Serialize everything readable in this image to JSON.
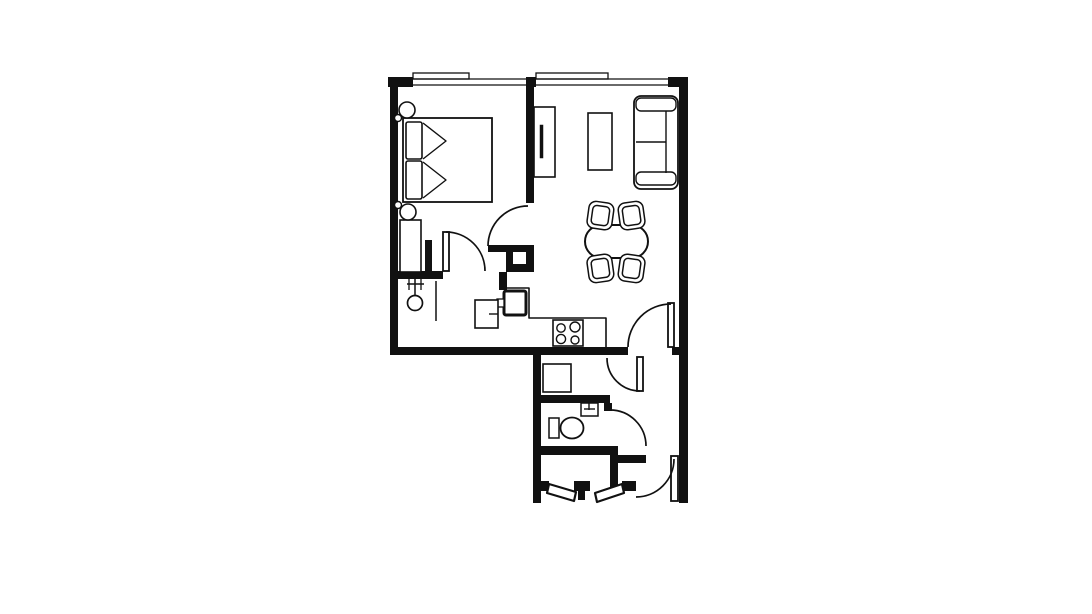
{
  "plan": {
    "colors": {
      "wall": "#111111",
      "bg": "#ffffff"
    },
    "walls": [
      {
        "n": "outer-wall-left",
        "r": [
          390,
          78,
          8,
          277
        ]
      },
      {
        "n": "top-wall-corner-left",
        "r": [
          388,
          77,
          25,
          10
        ]
      },
      {
        "n": "top-wall-pier-middle",
        "r": [
          526,
          77,
          10,
          10
        ]
      },
      {
        "n": "top-wall-corner-right",
        "r": [
          668,
          77,
          20,
          10
        ]
      },
      {
        "n": "outer-wall-right",
        "r": [
          679,
          78,
          9,
          425
        ]
      },
      {
        "n": "bottom-wall-main",
        "r": [
          390,
          347,
          238,
          8
        ]
      },
      {
        "n": "bottom-wall-right-stub",
        "r": [
          672,
          347,
          8,
          8
        ]
      },
      {
        "n": "dividing-wall-bedroom-living",
        "r": [
          526,
          78,
          8,
          125
        ]
      },
      {
        "n": "bedroom-door-open-leaf-bar",
        "r": [
          488,
          245,
          46,
          7
        ]
      },
      {
        "n": "dividing-wall-corner",
        "r": [
          526,
          245,
          8,
          27
        ]
      },
      {
        "n": "kitchen-nook-step-vertical",
        "r": [
          506,
          252,
          7,
          20
        ]
      },
      {
        "n": "kitchen-nook-step-horizontal",
        "r": [
          513,
          264,
          21,
          8
        ]
      },
      {
        "n": "kitchen-wall-stub",
        "r": [
          499,
          272,
          8,
          18
        ]
      },
      {
        "n": "bedroom-hall-wall",
        "r": [
          398,
          271,
          45,
          8
        ]
      },
      {
        "n": "hall-wall-stub",
        "r": [
          425,
          240,
          7,
          31
        ]
      },
      {
        "n": "lower-wing-wall-left",
        "r": [
          533,
          351,
          8,
          152
        ]
      },
      {
        "n": "laundry-bottom-wall",
        "r": [
          533,
          395,
          77,
          8
        ]
      },
      {
        "n": "bathroom-bottom-wall",
        "r": [
          533,
          446,
          85,
          9
        ]
      },
      {
        "n": "bathroom-step-vertical",
        "r": [
          610,
          446,
          8,
          17
        ]
      },
      {
        "n": "bathroom-step-horizontal",
        "r": [
          610,
          455,
          36,
          8
        ]
      },
      {
        "n": "vestibule-wall-right",
        "r": [
          610,
          455,
          8,
          36
        ]
      },
      {
        "n": "vestibule-jamb-left",
        "r": [
          533,
          481,
          16,
          10
        ]
      },
      {
        "n": "vestibule-jamb-center",
        "r": [
          574,
          481,
          16,
          10
        ]
      },
      {
        "n": "vestibule-center-post",
        "r": [
          578,
          491,
          7,
          9
        ]
      },
      {
        "n": "vestibule-jamb-right",
        "r": [
          622,
          481,
          14,
          10
        ]
      },
      {
        "n": "bathroom-door-jamb",
        "r": [
          604,
          403,
          8,
          8
        ]
      }
    ],
    "rects": [
      {
        "n": "window-sill-left",
        "r": [
          413,
          73,
          56,
          6
        ],
        "sw": 1.3
      },
      {
        "n": "window-sill-right",
        "r": [
          536,
          73,
          72,
          6
        ],
        "sw": 1.3
      },
      {
        "n": "bed",
        "r": [
          403,
          118,
          89,
          84
        ],
        "sw": 1.8
      },
      {
        "n": "bed-pillow-top",
        "r": [
          406,
          122,
          16,
          37
        ],
        "rx": 2
      },
      {
        "n": "bed-pillow-bottom",
        "r": [
          406,
          161,
          16,
          38
        ],
        "rx": 2
      },
      {
        "n": "wardrobe",
        "r": [
          400,
          220,
          21,
          52
        ]
      },
      {
        "n": "tv-unit",
        "r": [
          534,
          107,
          21,
          70
        ]
      },
      {
        "n": "tv-screen",
        "r": [
          540,
          125,
          3,
          33
        ],
        "f": "#111111",
        "sw": 0.5
      },
      {
        "n": "coffee-table",
        "r": [
          588,
          113,
          24,
          57
        ]
      },
      {
        "n": "sofa-body",
        "r": [
          634,
          96,
          44,
          93
        ],
        "rx": 7,
        "sw": 1.8
      },
      {
        "n": "sofa-armrest-top",
        "r": [
          636,
          98,
          40,
          13
        ],
        "rx": 5,
        "sw": 1.4
      },
      {
        "n": "sofa-armrest-bottom",
        "r": [
          636,
          172,
          40,
          13
        ],
        "rx": 5,
        "sw": 1.4
      },
      {
        "n": "dining-table",
        "r": [
          585,
          225,
          63,
          33
        ],
        "rx": 16.5,
        "sw": 2
      },
      {
        "n": "dining-chair-top-left-outer",
        "r": [
          588,
          202,
          25,
          27
        ],
        "rx": 7,
        "sw": 1.5,
        "t": [
          8,
          600,
          215
        ]
      },
      {
        "n": "dining-chair-top-left-inner",
        "r": [
          592,
          206,
          17,
          19
        ],
        "rx": 4,
        "sw": 1.5,
        "t": [
          8,
          600,
          215
        ]
      },
      {
        "n": "dining-chair-top-right-outer",
        "r": [
          619,
          202,
          25,
          27
        ],
        "rx": 7,
        "sw": 1.5,
        "t": [
          -8,
          632,
          215
        ]
      },
      {
        "n": "dining-chair-top-right-inner",
        "r": [
          623,
          206,
          17,
          19
        ],
        "rx": 4,
        "sw": 1.5,
        "t": [
          -8,
          632,
          215
        ]
      },
      {
        "n": "dining-chair-bottom-left-outer",
        "r": [
          588,
          255,
          25,
          27
        ],
        "rx": 7,
        "sw": 1.5,
        "t": [
          -8,
          600,
          269
        ]
      },
      {
        "n": "dining-chair-bottom-left-inner",
        "r": [
          592,
          259,
          17,
          19
        ],
        "rx": 4,
        "sw": 1.5,
        "t": [
          -8,
          600,
          269
        ]
      },
      {
        "n": "dining-chair-bottom-right-outer",
        "r": [
          619,
          255,
          25,
          27
        ],
        "rx": 7,
        "sw": 1.5,
        "t": [
          8,
          632,
          269
        ]
      },
      {
        "n": "dining-chair-bottom-right-inner",
        "r": [
          623,
          259,
          17,
          19
        ],
        "rx": 4,
        "sw": 1.5,
        "t": [
          8,
          632,
          269
        ]
      },
      {
        "n": "kitchen-sink",
        "r": [
          504,
          291,
          22,
          24
        ],
        "rx": 2,
        "sw": 3
      },
      {
        "n": "kitchen-sink-tap",
        "r": [
          497,
          299,
          7,
          8
        ],
        "sw": 1.3
      },
      {
        "n": "kitchen-cabinet",
        "r": [
          475,
          300,
          23,
          28
        ]
      },
      {
        "n": "stove",
        "r": [
          553,
          320,
          30,
          26
        ]
      },
      {
        "n": "bedroom-door-leaf",
        "r": [
          443,
          232,
          6,
          39
        ],
        "sw": 1.8
      },
      {
        "n": "living-room-door-leaf",
        "r": [
          668,
          303,
          6,
          44
        ],
        "sw": 1.8
      },
      {
        "n": "laundry-door-leaf",
        "r": [
          637,
          357,
          6,
          34
        ],
        "sw": 1.8
      },
      {
        "n": "entry-door-leaf",
        "r": [
          671,
          456,
          7,
          45
        ],
        "sw": 1.8
      },
      {
        "n": "washing-machine",
        "r": [
          543,
          364,
          28,
          28
        ]
      },
      {
        "n": "bathroom-sink",
        "r": [
          581,
          403,
          17,
          13
        ],
        "sw": 1.5
      },
      {
        "n": "toilet-tank",
        "r": [
          549,
          418,
          10,
          20
        ],
        "sw": 1.5
      }
    ],
    "polylines": [
      {
        "n": "bed-fold-chevron-top",
        "pts": "423,123 446,141 423,159",
        "sw": 1.4
      },
      {
        "n": "bed-fold-chevron-bottom",
        "pts": "423,162 446,180 423,198",
        "sw": 1.4
      },
      {
        "n": "kitchen-counter-edge",
        "pts": "507,288 529,288 529,318 606,318 606,347",
        "sw": 1.6
      }
    ],
    "polygons": [
      {
        "n": "vestibule-door-leaf-left",
        "pts": "549,484 576,492 574,501 547,493",
        "sw": 2.2
      },
      {
        "n": "vestibule-door-leaf-right",
        "pts": "622,484 595,493 597,502 624,493",
        "sw": 2.2
      }
    ],
    "lines": [
      {
        "n": "window-left-glass-outer",
        "p": [
          413,
          79,
          526,
          79
        ],
        "sw": 1.3
      },
      {
        "n": "window-left-glass-inner",
        "p": [
          413,
          85,
          526,
          85
        ],
        "sw": 1.3
      },
      {
        "n": "window-right-glass-outer",
        "p": [
          536,
          79,
          668,
          79
        ],
        "sw": 1.3
      },
      {
        "n": "window-right-glass-inner",
        "p": [
          536,
          85,
          668,
          85
        ],
        "sw": 1.3
      },
      {
        "n": "sofa-backrest-line",
        "p": [
          666,
          111,
          666,
          173
        ],
        "sw": 1.4
      },
      {
        "n": "sofa-seat-divider",
        "p": [
          636,
          142,
          666,
          142
        ],
        "sw": 1.4
      },
      {
        "n": "coat-stand-pole",
        "p": [
          415,
          277,
          415,
          296
        ],
        "sw": 1.5
      },
      {
        "n": "coat-stand-bar",
        "p": [
          407,
          284,
          424,
          284
        ],
        "sw": 1.5
      },
      {
        "n": "coat-stand-hook-left",
        "p": [
          409,
          279,
          409,
          290
        ],
        "sw": 1.3
      },
      {
        "n": "coat-stand-hook-right",
        "p": [
          421,
          279,
          421,
          290
        ],
        "sw": 1.3
      },
      {
        "n": "hall-partition-line",
        "p": [
          436,
          281,
          436,
          321
        ],
        "sw": 1.5
      },
      {
        "n": "kitchen-cabinet-handle",
        "p": [
          489,
          314,
          498,
          314
        ],
        "sw": 1.4
      },
      {
        "n": "bathroom-sink-tap-vertical",
        "p": [
          589,
          403,
          589,
          410
        ],
        "sw": 1.4
      },
      {
        "n": "bathroom-sink-tap-horizontal",
        "p": [
          584,
          409,
          595,
          409
        ],
        "sw": 1.4
      }
    ],
    "circles": [
      {
        "n": "nightstand-lamp-top",
        "c": [
          407,
          110,
          8
        ],
        "sw": 1.6
      },
      {
        "n": "wall-sconce-top",
        "c": [
          398,
          118,
          3.5
        ],
        "sw": 1.4
      },
      {
        "n": "nightstand-lamp-bottom",
        "c": [
          408,
          212,
          8
        ],
        "sw": 1.6
      },
      {
        "n": "wall-sconce-bottom",
        "c": [
          398,
          205,
          3.5
        ],
        "sw": 1.4
      },
      {
        "n": "coat-stand-head",
        "c": [
          415,
          303,
          7.5
        ],
        "sw": 1.7
      },
      {
        "n": "stove-burner-top-left",
        "c": [
          561,
          328,
          4.2
        ],
        "sw": 1.4
      },
      {
        "n": "stove-burner-top-right",
        "c": [
          575,
          327,
          5
        ],
        "sw": 1.4
      },
      {
        "n": "stove-burner-bottom-left",
        "c": [
          561,
          339,
          4.6
        ],
        "sw": 1.4
      },
      {
        "n": "stove-burner-bottom-right",
        "c": [
          575,
          340,
          4
        ],
        "sw": 1.4
      }
    ],
    "ellipses": [
      {
        "n": "toilet-bowl",
        "c": [
          572,
          428,
          11.5,
          10.5
        ],
        "sw": 1.8
      }
    ],
    "arcs": [
      {
        "n": "bedroom-living-door-arc",
        "d": "M488,246 A40,40 0 0 1 528,206",
        "sw": 1.7
      },
      {
        "n": "bedroom-hall-door-arc",
        "d": "M446,232 A39,39 0 0 1 485,271",
        "sw": 1.7
      },
      {
        "n": "living-corridor-door-arc",
        "d": "M671,304 A43,43 0 0 0 628,347",
        "sw": 1.7
      },
      {
        "n": "laundry-door-arc",
        "d": "M607,358 A33,33 0 0 0 640,391",
        "sw": 1.7
      },
      {
        "n": "bathroom-door-arc",
        "d": "M610,410 A36,36 0 0 1 646,446",
        "sw": 1.7
      },
      {
        "n": "entry-door-arc",
        "d": "M674,459 A38,38 0 0 1 636,497",
        "sw": 1.7
      }
    ]
  }
}
